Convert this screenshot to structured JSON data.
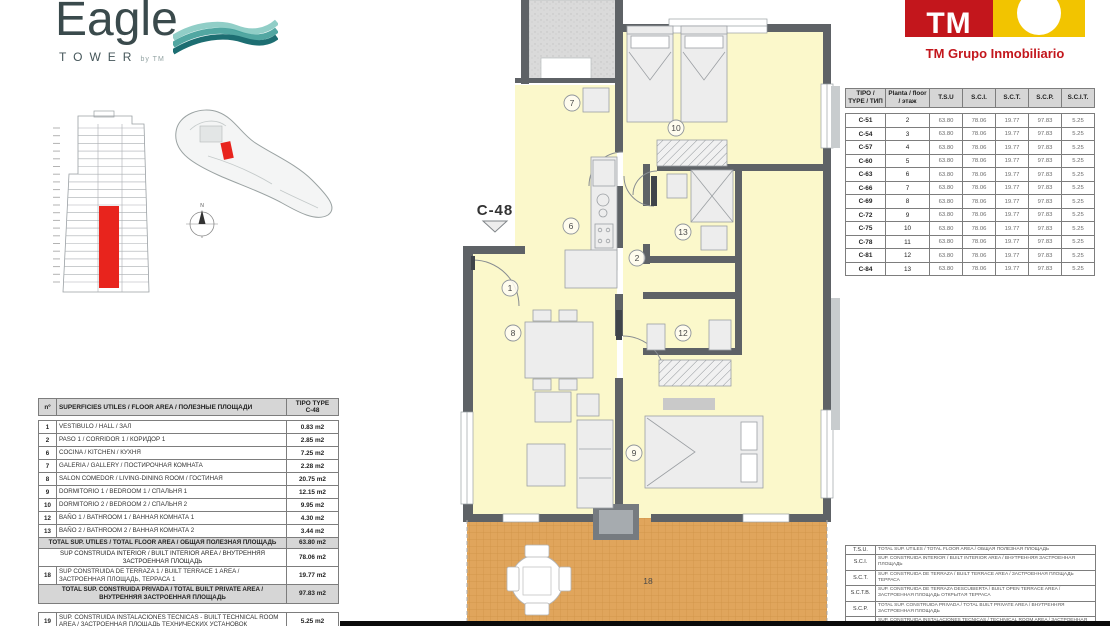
{
  "branding": {
    "eagle_title": "Eagle",
    "eagle_subtitle": "TOWER",
    "eagle_by": "by TM",
    "tm_mark": "TM",
    "tm_company": "TM Grupo Inmobiliario",
    "accent_red": "#C3161C",
    "accent_yellow": "#F2C400",
    "wave_teal": "#2E8F8A"
  },
  "plan": {
    "unit_label": "C-48",
    "room_fill": "#FBF8CB",
    "terrace_fill": "#E0A55C",
    "wall_color": "#5E6266",
    "highlight_red": "#E8241D",
    "room_labels": [
      {
        "t": "1",
        "x": 55,
        "y": 288,
        "circle": true
      },
      {
        "t": "2",
        "x": 182,
        "y": 258,
        "circle": true
      },
      {
        "t": "6",
        "x": 116,
        "y": 226,
        "circle": true
      },
      {
        "t": "7",
        "x": 117,
        "y": 103,
        "circle": true
      },
      {
        "t": "8",
        "x": 58,
        "y": 333,
        "circle": true
      },
      {
        "t": "9",
        "x": 179,
        "y": 453,
        "circle": true
      },
      {
        "t": "10",
        "x": 221,
        "y": 128,
        "circle": true
      },
      {
        "t": "12",
        "x": 228,
        "y": 333,
        "circle": true
      },
      {
        "t": "13",
        "x": 228,
        "y": 232,
        "circle": true
      },
      {
        "t": "18",
        "x": 193,
        "y": 581,
        "circle": false
      }
    ]
  },
  "site_plan": {
    "compass_n": "N"
  },
  "areas_table": {
    "header": {
      "n": "nº",
      "title": "SUPERFICIES UTILES / FLOOR AREA / ПОЛЕЗНЫЕ ПЛОЩАДИ",
      "type_line1": "TIPO TYPE",
      "type_line2": "C-48"
    },
    "rows": [
      {
        "n": "1",
        "label": "VESTIBULO / HALL / ЗАЛ",
        "value": "0.83 m2"
      },
      {
        "n": "2",
        "label": "PASO 1 / CORRIDOR 1 / КОРИДОР 1",
        "value": "2.85 m2"
      },
      {
        "n": "6",
        "label": "COCINA / KITCHEN / КУХНЯ",
        "value": "7.25 m2"
      },
      {
        "n": "7",
        "label": "GALERIA / GALLERY / ПОСТИРОЧНАЯ КОМНАТА",
        "value": "2.28 m2"
      },
      {
        "n": "8",
        "label": "SALON COMEDOR / LIVING-DINING ROOM / ГОСТИНАЯ",
        "value": "20.75 m2"
      },
      {
        "n": "9",
        "label": "DORMITORIO 1 / BEDROOM 1 / СПАЛЬНЯ 1",
        "value": "12.15 m2"
      },
      {
        "n": "10",
        "label": "DORMITORIO 2 / BEDROOM 2 / СПАЛЬНЯ 2",
        "value": "9.95 m2"
      },
      {
        "n": "12",
        "label": "BAÑO 1 / BATHROOM 1 / ВАННАЯ КОМНАТА 1",
        "value": "4.30 m2"
      },
      {
        "n": "13",
        "label": "BAÑO 2 / BATHROOM 2 / ВАННАЯ КОМНАТА 2",
        "value": "3.44 m2"
      },
      {
        "total": true,
        "label": "TOTAL SUP. UTILES / TOTAL FLOOR AREA / ОБЩАЯ ПОЛЕЗНАЯ ПЛОЩАДЬ",
        "value": "63.80 m2"
      },
      {
        "span": true,
        "label": "SUP CONSTRUIDA INTERIOR / BUILT INTERIOR AREA / ВНУТРЕННЯЯ ЗАСТРОЕННАЯ ПЛОЩАДЬ",
        "value": "78.06 m2"
      },
      {
        "n": "18",
        "label": "SUP CONSTRUIDA DE TERRAZA 1 / BUILT TERRACE 1 AREA / ЗАСТРОЕННАЯ ПЛОЩАДЬ, ТЕРРАСА 1",
        "value": "19.77 m2"
      },
      {
        "total": true,
        "label": "TOTAL SUP. CONSTRUIDA PRIVADA / TOTAL BUILT PRIVATE AREA / ВНУТРЕННЯЯ ЗАСТРОЕННАЯ ПЛОЩАДЬ",
        "value": "97.83 m2"
      }
    ],
    "tech_row": {
      "n": "19",
      "label": "SUP. CONSTRUIDA INSTALACIONES TECNICAS - BUILT TECHNICAL ROOM AREA / ЗАСТРОЕННАЯ ПЛОЩАДЬ ТЕХНИЧЕСКИХ УСТАНОВОК",
      "value": "5.25 m2"
    }
  },
  "types_table": {
    "headers": [
      "TIPO / TYPE / ТИП",
      "Planta / floor / этаж",
      "T.S.U",
      "S.C.I.",
      "S.C.T.",
      "S.C.P.",
      "S.C.I.T."
    ],
    "rows": [
      [
        "C-51",
        "2",
        "63.80",
        "78.06",
        "19.77",
        "97.83",
        "5.25"
      ],
      [
        "C-54",
        "3",
        "63.80",
        "78.06",
        "19.77",
        "97.83",
        "5.25"
      ],
      [
        "C-57",
        "4",
        "63.80",
        "78.06",
        "19.77",
        "97.83",
        "5.25"
      ],
      [
        "C-60",
        "5",
        "63.80",
        "78.06",
        "19.77",
        "97.83",
        "5.25"
      ],
      [
        "C-63",
        "6",
        "63.80",
        "78.06",
        "19.77",
        "97.83",
        "5.25"
      ],
      [
        "C-66",
        "7",
        "63.80",
        "78.06",
        "19.77",
        "97.83",
        "5.25"
      ],
      [
        "C-69",
        "8",
        "63.80",
        "78.06",
        "19.77",
        "97.83",
        "5.25"
      ],
      [
        "C-72",
        "9",
        "63.80",
        "78.06",
        "19.77",
        "97.83",
        "5.25"
      ],
      [
        "C-75",
        "10",
        "63.80",
        "78.06",
        "19.77",
        "97.83",
        "5.25"
      ],
      [
        "C-78",
        "11",
        "63.80",
        "78.06",
        "19.77",
        "97.83",
        "5.25"
      ],
      [
        "C-81",
        "12",
        "63.80",
        "78.06",
        "19.77",
        "97.83",
        "5.25"
      ],
      [
        "C-84",
        "13",
        "63.80",
        "78.06",
        "19.77",
        "97.83",
        "5.25"
      ]
    ]
  },
  "legend_table": {
    "rows": [
      {
        "abbr": "T.S.U.",
        "desc": "TOTAL SUP. UTILES / TOTAL FLOOR AREA / ОБЩАЯ ПОЛЕЗНАЯ ПЛОЩАДЬ"
      },
      {
        "abbr": "S.C.I.",
        "desc": "SUP. CONSTRUIDA INTERIOR / BUILT INTERIOR AREA / ВНУТРЕННЯЯ ЗАСТРОЕННАЯ ПЛОЩАДЬ"
      },
      {
        "abbr": "S.C.T.",
        "desc": "SUP. CONSTRUIDA DE TERRAZA / BUILT TERRACE AREA / ЗАСТРОЕННАЯ ПЛОЩАДЬ ТЕРРАСА"
      },
      {
        "abbr": "S.C.T.B.",
        "desc": "SUP. CONSTRUIDA DE TERRAZA DESCUBIERTA / BUILT OPEN TERRACE AREA / ЗАСТРОЕННАЯ ПЛОЩАДЬ ОТКРЫТАЯ ТЕРРАСА"
      },
      {
        "abbr": "S.C.P.",
        "desc": "TOTAL SUP. CONSTRUIDA PRIVADA / TOTAL BUILT PRIVATE AREA / ВНУТРЕННЯЯ ЗАСТРОЕННАЯ ПЛОЩАДЬ"
      },
      {
        "abbr": "S.C.I.T.",
        "desc": "SUP. CONSTRUIDA INSTALACIONES TECNICAS / TECHNICAL ROOM AREA / ЗАСТРОЕННАЯ ПЛОЩАДЬ ТЕХНИЧЕСКИХ УСТАНОВОК"
      }
    ]
  }
}
